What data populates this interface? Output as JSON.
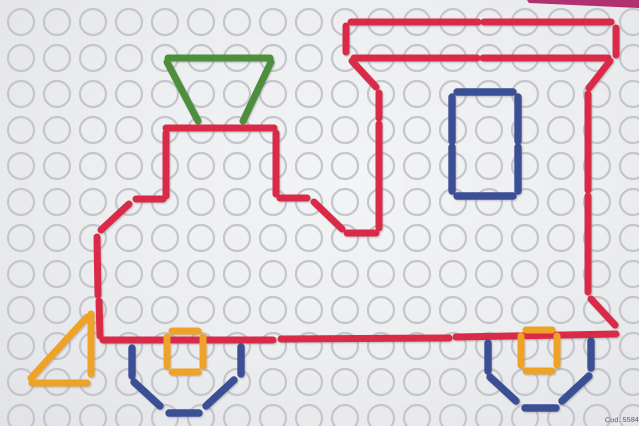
{
  "board": {
    "bg_color": "#edeef0",
    "code_label": "Cod. 5584",
    "edge_strip": {
      "color": "#b03070",
      "points": "527,0 639,0 639,8 529,3"
    },
    "grid": {
      "cols": 18,
      "rows": 12,
      "start_x": 21,
      "start_y": 22,
      "spacing": 36,
      "radius": 13,
      "ring_color": "#c5c6cb",
      "ring_width": 2.2
    }
  },
  "figure": {
    "subject": "toy locomotive outline made of peg rods",
    "colors": {
      "red": "#d92a46",
      "green": "#4d8f3e",
      "blue": "#3b5095",
      "orange": "#efa328"
    },
    "stroke_width": {
      "red": 7,
      "green": 7,
      "blue": 7.4,
      "orange": 7
    },
    "segments": [
      {
        "n": "roof-top-bar-1",
        "c": "red",
        "p": [
          351,
          22,
          478,
          22
        ]
      },
      {
        "n": "roof-top-bar-2",
        "c": "red",
        "p": [
          484,
          22,
          611,
          22
        ]
      },
      {
        "n": "roof-left-stub",
        "c": "red",
        "p": [
          346,
          26,
          346,
          52
        ]
      },
      {
        "n": "roof-right-stub",
        "c": "red",
        "p": [
          616,
          28,
          616,
          55
        ]
      },
      {
        "n": "roof-lower-bar-1",
        "c": "red",
        "p": [
          354,
          58,
          477,
          58
        ]
      },
      {
        "n": "roof-lower-bar-2",
        "c": "red",
        "p": [
          483,
          58,
          608,
          58
        ]
      },
      {
        "n": "roof-diagonal-left",
        "c": "red",
        "p": [
          352,
          61,
          376,
          87
        ]
      },
      {
        "n": "roof-diagonal-right",
        "c": "red",
        "p": [
          610,
          61,
          589,
          88
        ]
      },
      {
        "n": "cab-front-vertical-1",
        "c": "red",
        "p": [
          379,
          93,
          379,
          118
        ]
      },
      {
        "n": "cab-front-vertical-2",
        "c": "red",
        "p": [
          379,
          124,
          379,
          228
        ]
      },
      {
        "n": "under-cab-horizontal",
        "c": "red",
        "p": [
          347,
          233,
          376,
          233
        ]
      },
      {
        "n": "boiler-step-right-diagonal",
        "c": "red",
        "p": [
          314,
          202,
          342,
          229
        ]
      },
      {
        "n": "boiler-step-right-horizontal",
        "c": "red",
        "p": [
          280,
          198,
          307,
          198
        ]
      },
      {
        "n": "boiler-right-vertical",
        "c": "red",
        "p": [
          276,
          133,
          276,
          194
        ]
      },
      {
        "n": "boiler-top-bar",
        "c": "red",
        "p": [
          166,
          128,
          274,
          128
        ]
      },
      {
        "n": "boiler-left-vertical",
        "c": "red",
        "p": [
          166,
          133,
          166,
          196
        ]
      },
      {
        "n": "boiler-step-left-horizontal",
        "c": "red",
        "p": [
          136,
          199,
          163,
          199
        ]
      },
      {
        "n": "boiler-step-left-diagonal",
        "c": "red",
        "p": [
          129,
          204,
          101,
          230
        ]
      },
      {
        "n": "front-wall-vertical-1",
        "c": "red",
        "p": [
          97,
          237,
          98,
          295
        ]
      },
      {
        "n": "front-wall-vertical-2",
        "c": "red",
        "p": [
          99,
          301,
          100,
          336
        ]
      },
      {
        "n": "chassis-bottom-1",
        "c": "red",
        "p": [
          103,
          340,
          273,
          340
        ]
      },
      {
        "n": "chassis-bottom-2",
        "c": "red",
        "p": [
          281,
          339,
          449,
          338
        ]
      },
      {
        "n": "chassis-bottom-3",
        "c": "red",
        "p": [
          456,
          337,
          616,
          334
        ]
      },
      {
        "n": "rear-wall-vertical-1",
        "c": "red",
        "p": [
          588,
          94,
          588,
          190
        ]
      },
      {
        "n": "rear-wall-vertical-2",
        "c": "red",
        "p": [
          588,
          196,
          588,
          292
        ]
      },
      {
        "n": "rear-bottom-diagonal",
        "c": "red",
        "p": [
          591,
          299,
          615,
          325
        ]
      },
      {
        "n": "funnel-top-bar",
        "c": "green",
        "p": [
          168,
          58,
          270,
          58
        ]
      },
      {
        "n": "funnel-left-diagonal",
        "c": "green",
        "p": [
          167,
          62,
          198,
          121
        ]
      },
      {
        "n": "funnel-right-diagonal",
        "c": "green",
        "p": [
          271,
          62,
          243,
          121
        ]
      },
      {
        "n": "window-top-bar",
        "c": "blue",
        "p": [
          457,
          92,
          513,
          92
        ]
      },
      {
        "n": "window-bottom-bar",
        "c": "blue",
        "p": [
          457,
          196,
          513,
          196
        ]
      },
      {
        "n": "window-left-bar-1",
        "c": "blue",
        "p": [
          452,
          97,
          452,
          141
        ]
      },
      {
        "n": "window-left-bar-2",
        "c": "blue",
        "p": [
          452,
          147,
          452,
          191
        ]
      },
      {
        "n": "window-right-bar-1",
        "c": "blue",
        "p": [
          518,
          97,
          518,
          141
        ]
      },
      {
        "n": "window-right-bar-2",
        "c": "blue",
        "p": [
          518,
          147,
          518,
          191
        ]
      },
      {
        "n": "front-wheel-left-vertical",
        "c": "blue",
        "p": [
          132,
          348,
          132,
          376
        ]
      },
      {
        "n": "front-wheel-left-diagonal",
        "c": "blue",
        "p": [
          134,
          382,
          160,
          406
        ]
      },
      {
        "n": "front-wheel-bottom-bar",
        "c": "blue",
        "p": [
          169,
          413,
          199,
          413
        ]
      },
      {
        "n": "front-wheel-right-diagonal",
        "c": "blue",
        "p": [
          206,
          406,
          234,
          380
        ]
      },
      {
        "n": "front-wheel-right-vertical",
        "c": "blue",
        "p": [
          241,
          347,
          241,
          374
        ]
      },
      {
        "n": "rear-wheel-left-vertical",
        "c": "blue",
        "p": [
          488,
          343,
          488,
          371
        ]
      },
      {
        "n": "rear-wheel-left-diagonal",
        "c": "blue",
        "p": [
          490,
          377,
          516,
          401
        ]
      },
      {
        "n": "rear-wheel-bottom-bar",
        "c": "blue",
        "p": [
          525,
          408,
          556,
          408
        ]
      },
      {
        "n": "rear-wheel-right-diagonal",
        "c": "blue",
        "p": [
          562,
          401,
          589,
          376
        ]
      },
      {
        "n": "rear-wheel-right-vertical",
        "c": "blue",
        "p": [
          591,
          341,
          591,
          368
        ]
      },
      {
        "n": "front-hub-top-bar",
        "c": "orange",
        "p": [
          172,
          331,
          198,
          331
        ]
      },
      {
        "n": "front-hub-left-bar",
        "c": "orange",
        "p": [
          167,
          337,
          167,
          366
        ]
      },
      {
        "n": "front-hub-right-bar",
        "c": "orange",
        "p": [
          203,
          337,
          203,
          366
        ]
      },
      {
        "n": "front-hub-bottom-bar",
        "c": "orange",
        "p": [
          172,
          372,
          198,
          372
        ]
      },
      {
        "n": "rear-hub-top-bar",
        "c": "orange",
        "p": [
          526,
          330,
          552,
          330
        ]
      },
      {
        "n": "rear-hub-left-bar",
        "c": "orange",
        "p": [
          521,
          336,
          521,
          365
        ]
      },
      {
        "n": "rear-hub-right-bar",
        "c": "orange",
        "p": [
          557,
          336,
          557,
          365
        ]
      },
      {
        "n": "rear-hub-bottom-bar",
        "c": "orange",
        "p": [
          526,
          371,
          552,
          371
        ]
      },
      {
        "n": "cowcatcher-vertical",
        "c": "orange",
        "p": [
          91,
          314,
          91,
          374
        ]
      },
      {
        "n": "cowcatcher-hypotenuse",
        "c": "orange",
        "p": [
          87,
          317,
          31,
          378
        ]
      },
      {
        "n": "cowcatcher-bottom-bar",
        "c": "orange",
        "p": [
          32,
          383,
          87,
          383
        ]
      }
    ]
  }
}
